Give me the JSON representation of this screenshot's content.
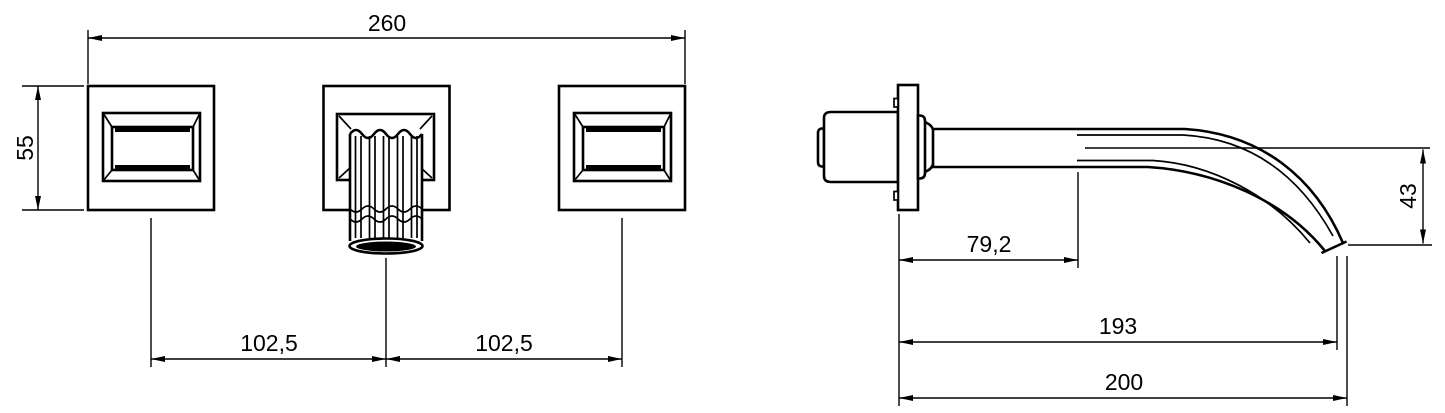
{
  "colors": {
    "line": "#000000",
    "background": "#ffffff"
  },
  "front_view": {
    "dims": {
      "overall_width": "260",
      "handle_plate_height": "55",
      "center_to_left_handle": "102,5",
      "center_to_right_handle": "102,5"
    }
  },
  "side_view": {
    "dims": {
      "wall_to_spout_body_end": "79,2",
      "spout_drop_height": "43",
      "wall_to_outlet": "193",
      "overall_reach": "200"
    }
  }
}
